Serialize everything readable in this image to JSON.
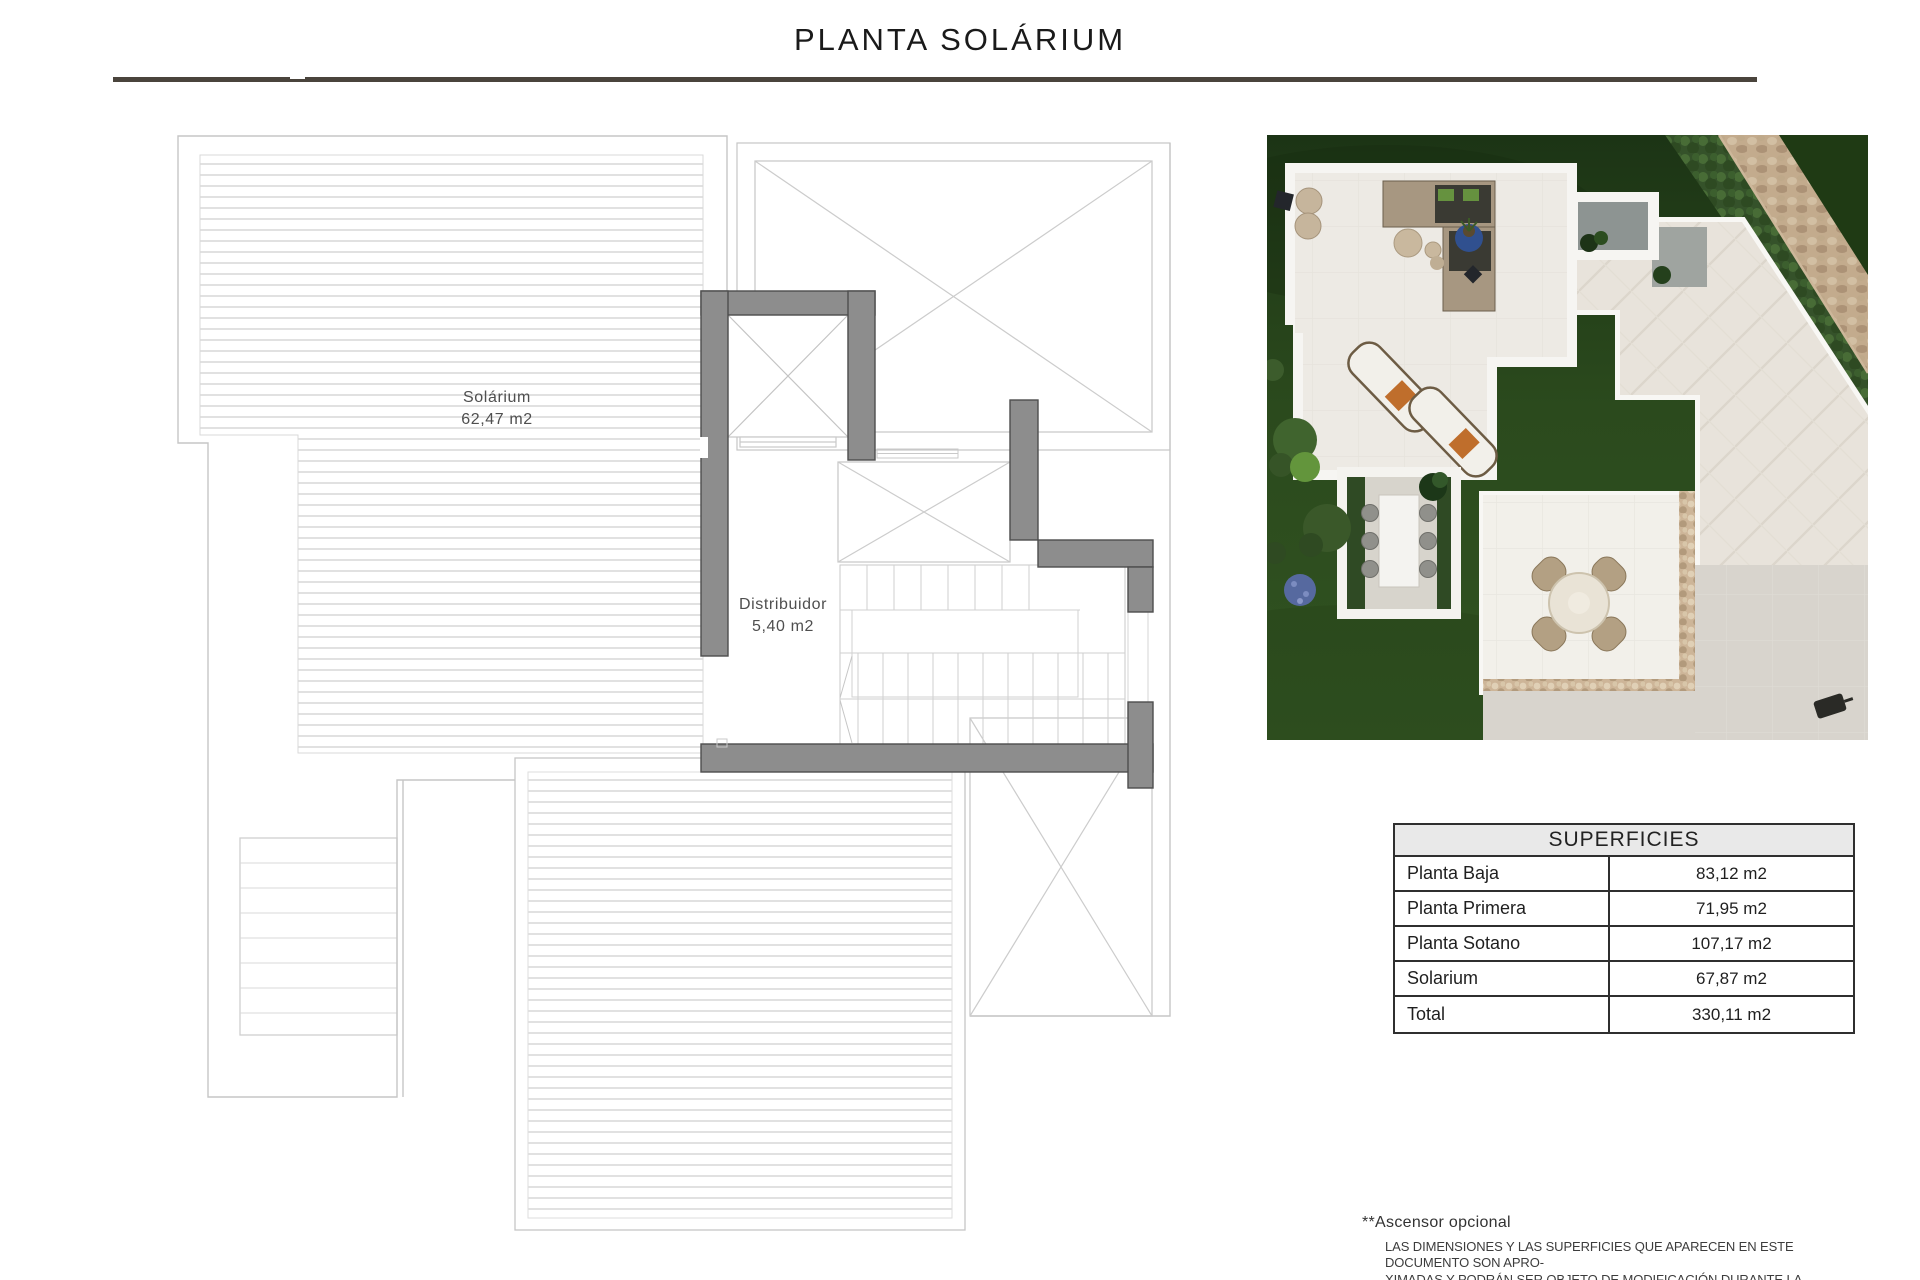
{
  "title": "PLANTA SOLÁRIUM",
  "plan": {
    "rooms": [
      {
        "name": "Solárium",
        "area": "62,47 m2"
      },
      {
        "name": "Distribuidor",
        "area": "5,40 m2"
      }
    ]
  },
  "table": {
    "title": "SUPERFICIES",
    "rows": [
      {
        "label": "Planta Baja",
        "value": "83,12 m2"
      },
      {
        "label": "Planta Primera",
        "value": "71,95 m2"
      },
      {
        "label": "Planta Sotano",
        "value": "107,17 m2"
      },
      {
        "label": "Solarium",
        "value": "67,87 m2"
      },
      {
        "label": "Total",
        "value": "330,11 m2"
      }
    ]
  },
  "footnotes": {
    "elevator_note": "**Ascensor opcional",
    "disclaimer_lines": [
      "LAS DIMENSIONES Y LAS SUPERFICIES QUE APARECEN EN ESTE DOCUMENTO SON APRO-",
      "XIMADAS Y PODRÁN SER OBJETO DE MODIFICACIÓN DURANTE LA REDACCIÓN DE LOS",
      "PROYECTOS BÁSICO Y DE EJECUCIÓN."
    ]
  },
  "colors": {
    "rule_color": "#4a443c",
    "plan_line": "#c6c6c6",
    "hatch_line": "#dcdcdc",
    "wall_gray": "#8d8d8d",
    "table_border": "#2f2f2f",
    "table_header_bg": "#e9e9e9",
    "grass": "#2c4b1e",
    "stone": "#c5ad8f"
  }
}
